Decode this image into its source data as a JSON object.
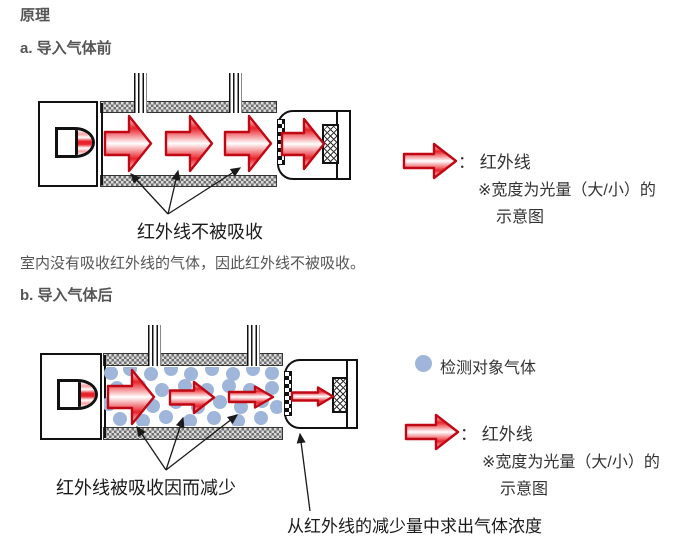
{
  "page": {
    "title": "原理"
  },
  "colors": {
    "infrared_red": "#e8232b",
    "arrow_border": "#c00814",
    "gas_blue": "#9fb6da",
    "wall_gray": "#6f6f6f",
    "heading_gray": "#555555",
    "label_black": "#1a1a1a"
  },
  "sections": {
    "a": {
      "heading": "a. 导入气体前",
      "diagram_label": "红外线不被吸收",
      "description": "室内没有吸收红外线的气体，因此红外线不被吸收。",
      "legend": {
        "arrow_label": "： 红外线",
        "note_line1": "※宽度为光量（大/小）的",
        "note_line2": "示意图"
      }
    },
    "b": {
      "heading": "b. 导入气体后",
      "diagram_label": "红外线被吸收因而减少",
      "bottom_label": "从红外线的减少量中求出气体浓度",
      "legend": {
        "gas_label": "检测对象气体",
        "arrow_label": "： 红外线",
        "note_line1": "※宽度为光量（大/小）的",
        "note_line2": "示意图"
      }
    }
  }
}
